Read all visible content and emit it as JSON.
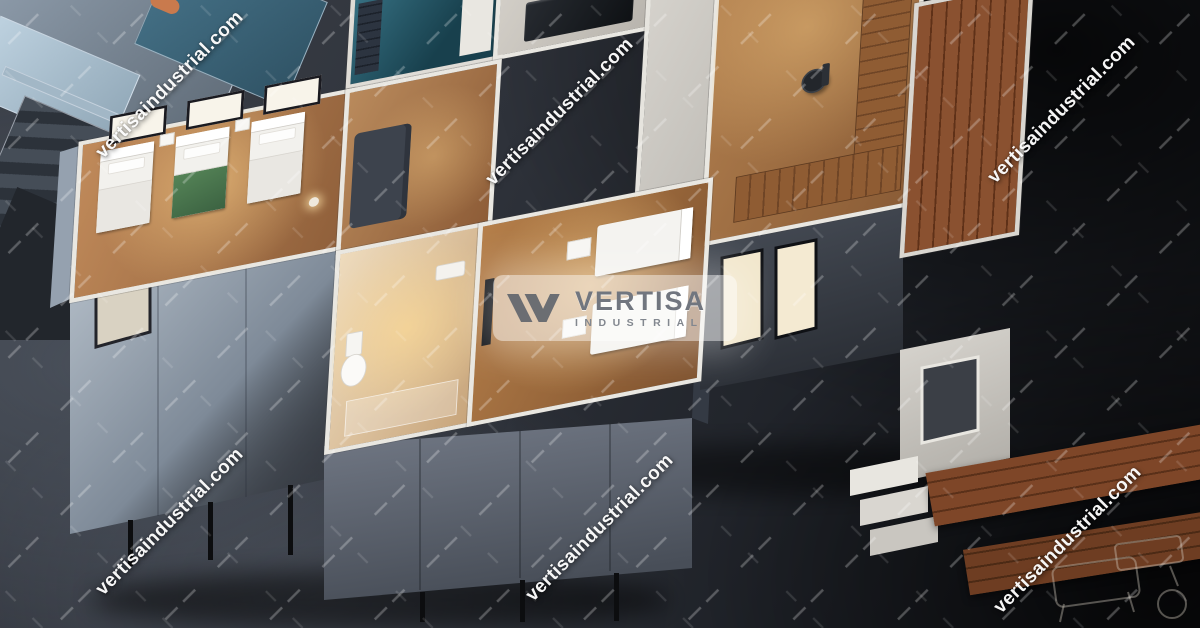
{
  "watermark": {
    "text": "vertisaindustrial.com",
    "color": "#ffffff"
  },
  "logo": {
    "brand": "VERTISA",
    "sub": "INDUSTRIAL",
    "mark_color": "#5f646c",
    "brand_color": "#71767f",
    "sub_color": "#82878f",
    "plate_color": "rgba(255,255,255,0.55)"
  },
  "scene": {
    "description": "Aerial cutaway view of a white modular container house model with furnished rooms, standing on a dark concrete floor",
    "palette": {
      "concrete_dark": "#23262b",
      "facade_blue_gray": "#8c98a6",
      "facade_charcoal": "#4a505a",
      "wall_white": "#e9e7e1",
      "wood_floor": "#b0805a",
      "deck_wood": "#7c4728",
      "laundry_teal": "#2f6b7d",
      "bathroom_cream": "#e8d3b4",
      "warm_light": "#ffd896",
      "bed_green": "#4e7b52"
    }
  }
}
